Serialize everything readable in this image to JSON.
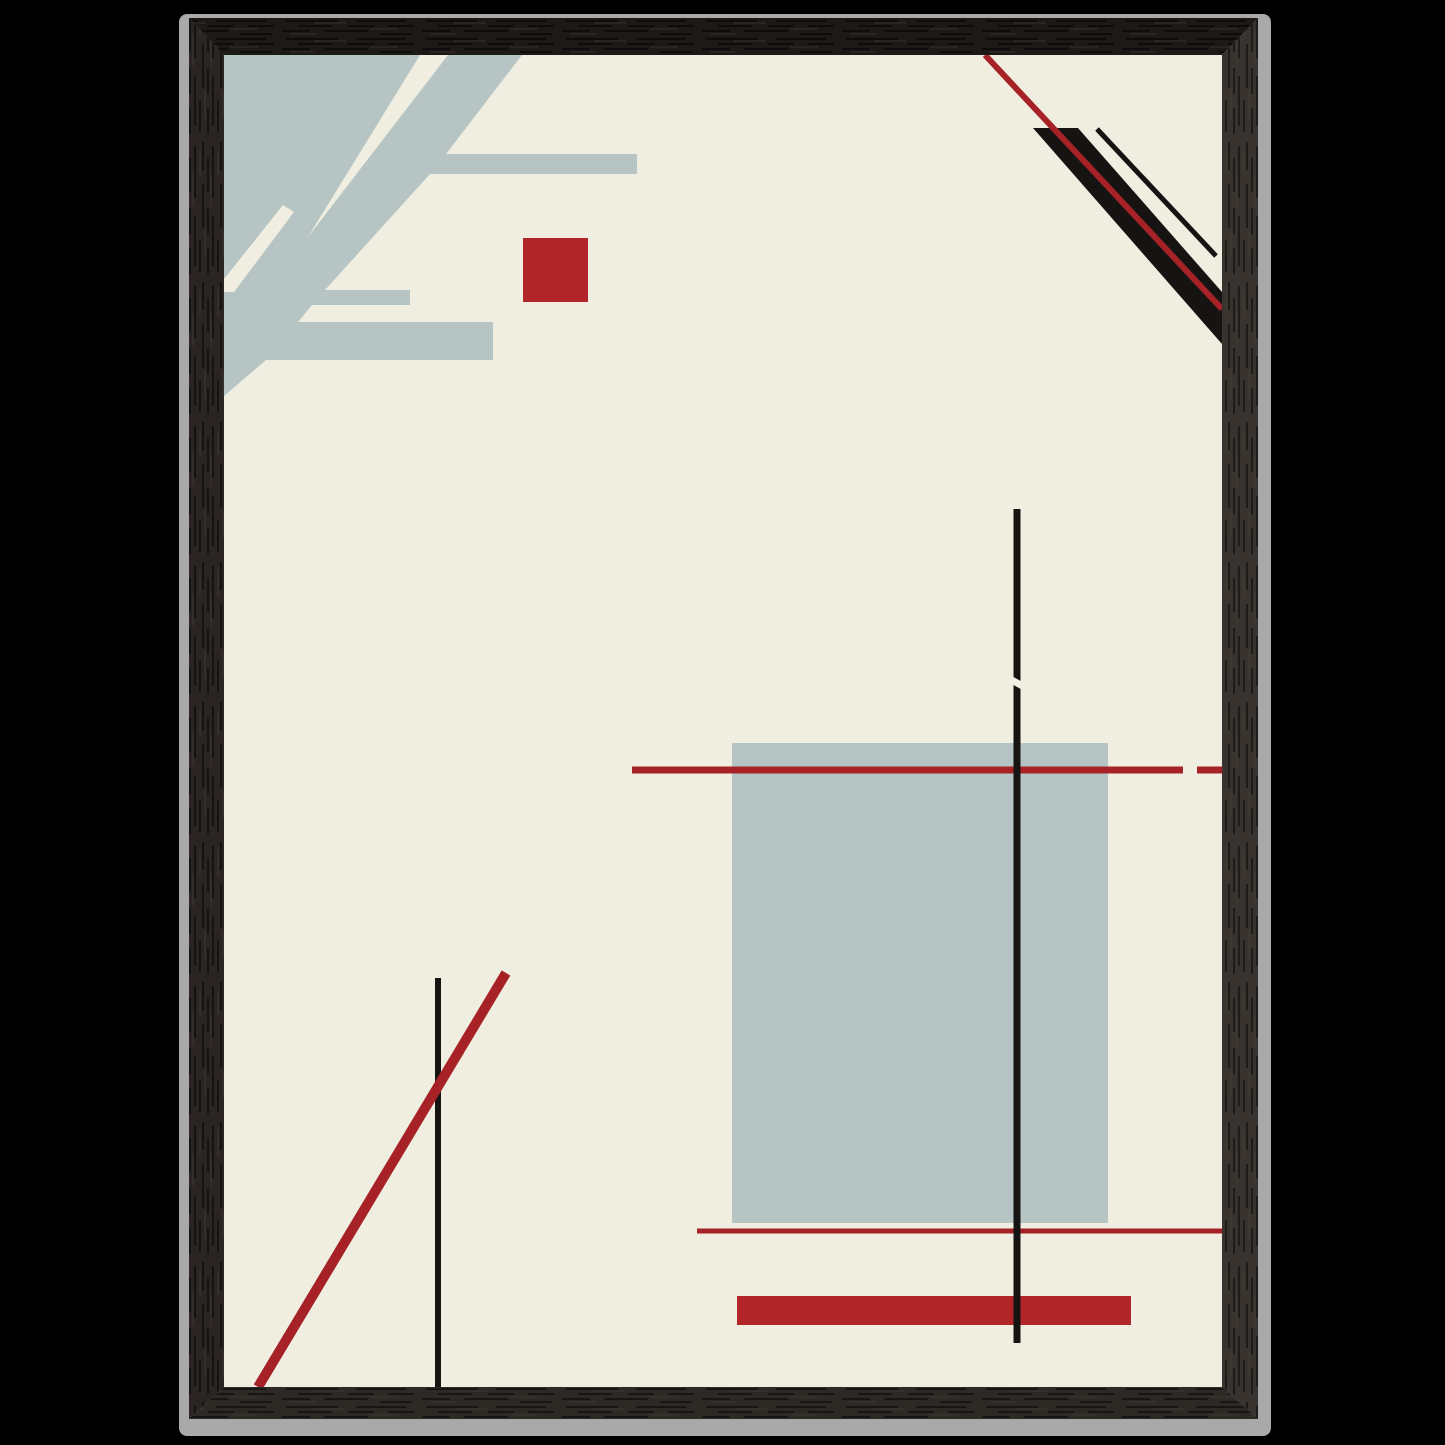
{
  "canvas": {
    "width": 1445,
    "height": 1445,
    "background": "#000000"
  },
  "palette": {
    "bg_black": "#000000",
    "edge_gray": "#a9a9a9",
    "edge_gray_bright": "#bdbdbd",
    "wood_top": "#1c1916",
    "wood_left": "#2a2522",
    "wood_right": "#38332e",
    "wood_bottom": "#2d2925",
    "paper": "#f0eee0",
    "slate": "#b6c5c3",
    "red": "#b2262a",
    "red_line": "#a62226",
    "ink": "#161412"
  },
  "frame": {
    "outer_edge": {
      "name": "frame-outer-edge",
      "x": 179,
      "y": 14,
      "w": 1092,
      "h": 1422,
      "rx": 8,
      "fill": "edge_gray"
    },
    "pieces": [
      {
        "name": "frame-top-rail",
        "points": "189,18 1258,18 1222,55 224,55",
        "fill": "wood_top",
        "grain": "h"
      },
      {
        "name": "frame-left-rail",
        "points": "189,18 224,55 224,1387 189,1419",
        "fill": "wood_left",
        "grain": "v"
      },
      {
        "name": "frame-right-rail",
        "points": "1258,18 1222,55 1222,1387 1258,1419",
        "fill": "wood_right",
        "grain": "v"
      },
      {
        "name": "frame-bottom-rail",
        "points": "189,1419 224,1387 1222,1387 1258,1419",
        "fill": "wood_bottom",
        "grain": "h"
      }
    ]
  },
  "artwork": {
    "name": "abstract-constructivist-print",
    "x": 224,
    "y": 55,
    "w": 998,
    "h": 1332,
    "background": "paper",
    "shapes": [
      {
        "name": "topleft-blue-mass",
        "type": "polygon",
        "fill": "slate",
        "points": "224,55 522,55 446,154 637,154 637,174 430,174 325,290 410,290 410,305 312,305 298,322 493,322 493,360 266,360 224,396"
      },
      {
        "name": "topleft-cream-wedge",
        "type": "polygon",
        "fill": "paper",
        "points": "420,55 448,55 308,237"
      },
      {
        "name": "topleft-cream-slash",
        "type": "polygon",
        "fill": "paper",
        "points": "283,205 294,212 234,292 224,292 224,279"
      },
      {
        "name": "red-square",
        "type": "rect",
        "fill": "red",
        "x": 523,
        "y": 238,
        "w": 65,
        "h": 64
      },
      {
        "name": "topright-black-band",
        "type": "polygon",
        "fill": "ink",
        "points": "1033,128 1078,128 1222,292 1222,344"
      },
      {
        "name": "topright-thin-black-line",
        "type": "line",
        "stroke": "ink",
        "w": 5,
        "x1": 1097,
        "y1": 129,
        "x2": 1216,
        "y2": 256
      },
      {
        "name": "topright-red-line",
        "type": "line",
        "stroke": "red_line",
        "w": 6,
        "x1": 985,
        "y1": 55,
        "x2": 1222,
        "y2": 309
      },
      {
        "name": "blue-rectangle",
        "type": "rect",
        "fill": "slate",
        "x": 732,
        "y": 743,
        "w": 376,
        "h": 480
      },
      {
        "name": "red-horizontal-line-upper",
        "type": "line",
        "stroke": "red_line",
        "w": 7,
        "x1": 632,
        "y1": 770,
        "x2": 1183,
        "y2": 770
      },
      {
        "name": "red-horizontal-line-upper-dash",
        "type": "line",
        "stroke": "red_line",
        "w": 7,
        "x1": 1197,
        "y1": 770,
        "x2": 1222,
        "y2": 770
      },
      {
        "name": "red-horizontal-line-lower",
        "type": "line",
        "stroke": "red_line",
        "w": 5,
        "x1": 697,
        "y1": 1231,
        "x2": 1222,
        "y2": 1231
      },
      {
        "name": "red-bar",
        "type": "rect",
        "fill": "red",
        "x": 737,
        "y": 1296,
        "w": 394,
        "h": 29
      },
      {
        "name": "center-vertical-line",
        "type": "line",
        "stroke": "ink",
        "w": 7,
        "x1": 1017,
        "y1": 509,
        "x2": 1017,
        "y2": 1343
      },
      {
        "name": "center-vertical-line-notch",
        "type": "polygon",
        "fill": "paper",
        "points": "1010,675 1026,684 1026,692 1010,683"
      },
      {
        "name": "bottomleft-vertical-line",
        "type": "line",
        "stroke": "ink",
        "w": 6,
        "x1": 438,
        "y1": 978,
        "x2": 438,
        "y2": 1387
      },
      {
        "name": "bottomleft-red-diagonal",
        "type": "line",
        "stroke": "red_line",
        "w": 10,
        "x1": 506,
        "y1": 973,
        "x2": 258,
        "y2": 1387
      }
    ]
  }
}
